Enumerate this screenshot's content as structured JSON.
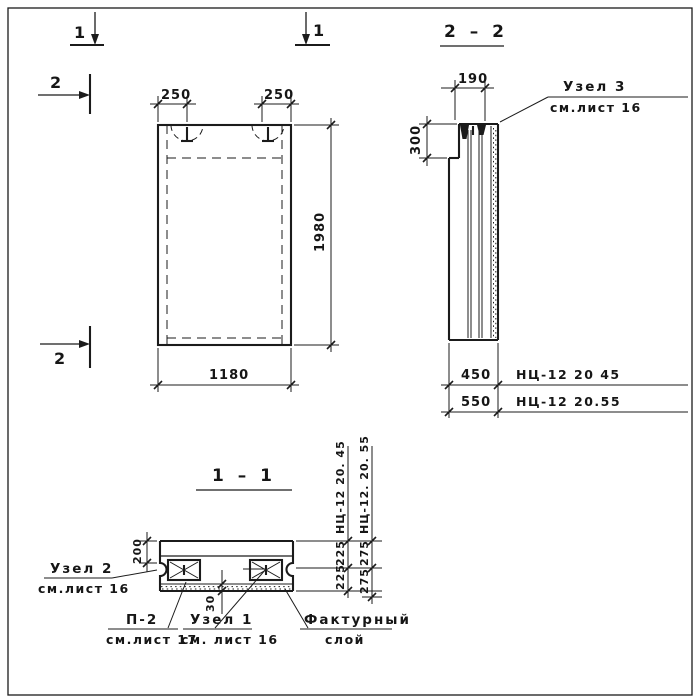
{
  "page": {
    "background": "#ffffff",
    "line_color": "#1b1b1b"
  },
  "markers": {
    "cut1_left": "1",
    "cut1_right": "1",
    "cut2_top": "2",
    "cut2_bottom": "2"
  },
  "elevation": {
    "dim_hook_left": "250",
    "dim_hook_right": "250",
    "dim_height": "1980",
    "dim_width": "1180"
  },
  "section22": {
    "title": "2 – 2",
    "dim_top": "190",
    "dim_step": "300",
    "dim_thickness_a": "450",
    "dim_thickness_b": "550",
    "mark_a": "НЦ-12 20 45",
    "mark_b": "НЦ-12 20.55",
    "node3_title": "Узел 3",
    "node3_ref": "см.лист 16"
  },
  "section11": {
    "title": "1 – 1",
    "dim_top_layer": "200",
    "dim_facing": "30",
    "chain_a_label": "НЦ-12 20. 45",
    "chain_a_dim1": "225",
    "chain_a_dim2": "225",
    "chain_b_label": "НЦ-12. 20. 55",
    "chain_b_dim1": "275",
    "chain_b_dim2": "275",
    "node2_title": "Узел 2",
    "node2_ref": "см.лист 16",
    "p2_title": "П-2",
    "p2_ref": "см.лист 17",
    "node1_title": "Узел 1",
    "node1_ref": "см. лист 16",
    "facing_line1": "Фактурный",
    "facing_line2": "слой"
  }
}
